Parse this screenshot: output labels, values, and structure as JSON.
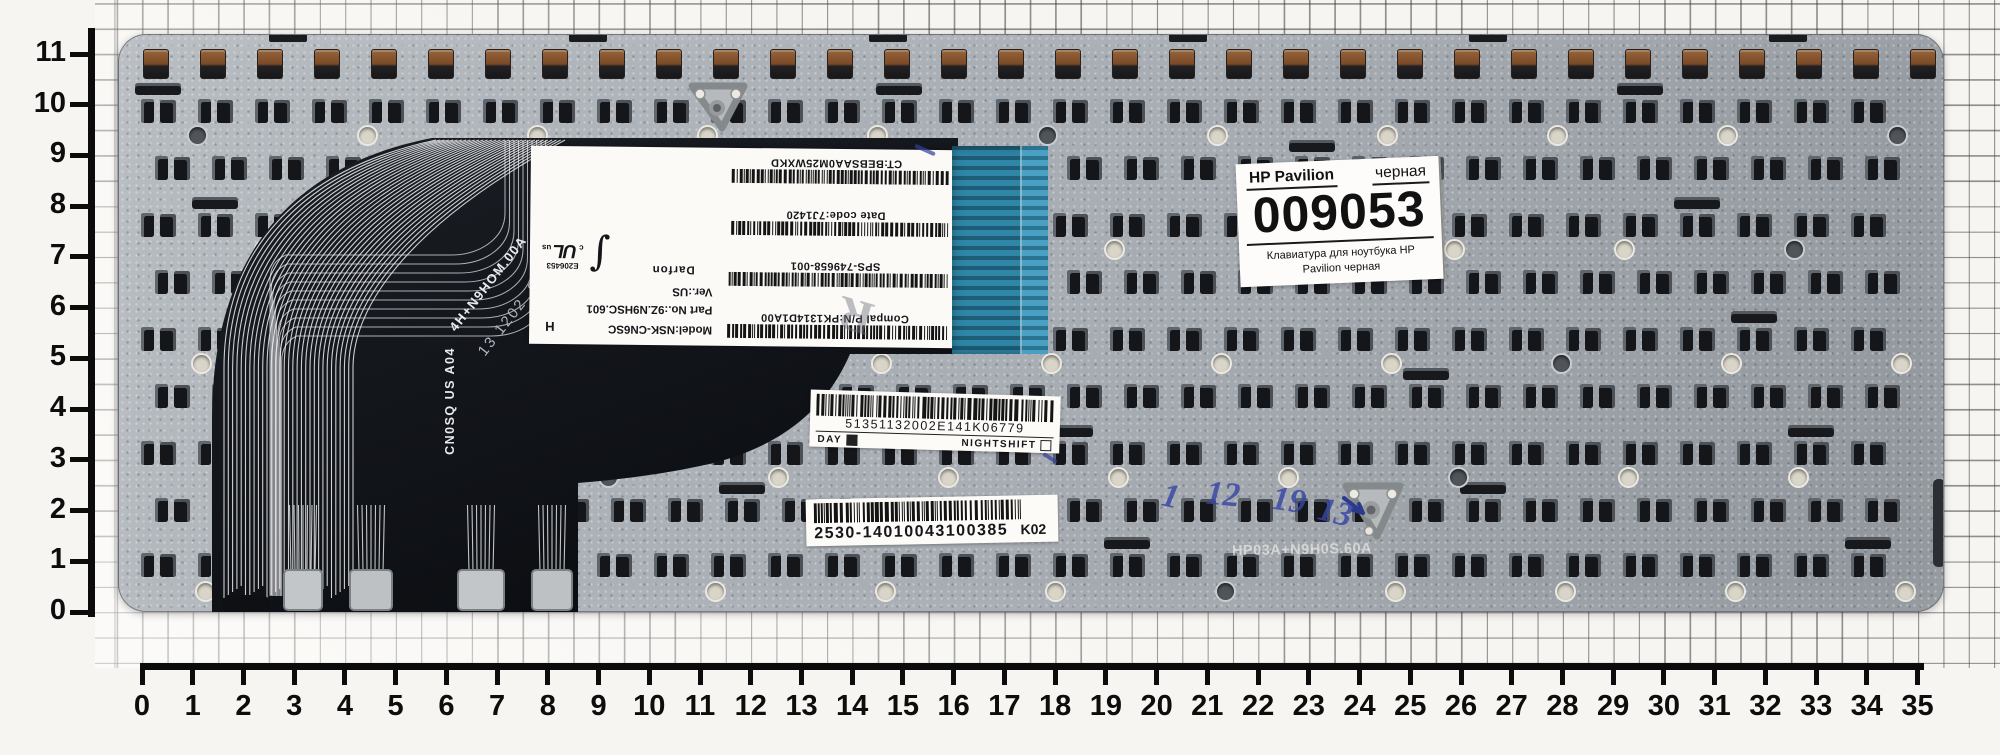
{
  "rulers": {
    "unit": "cm",
    "vertical_labels": [
      "0",
      "1",
      "2",
      "3",
      "4",
      "5",
      "6",
      "7",
      "8",
      "9",
      "10",
      "11"
    ],
    "horizontal_labels": [
      "0",
      "1",
      "2",
      "3",
      "4",
      "5",
      "6",
      "7",
      "8",
      "9",
      "10",
      "11",
      "12",
      "13",
      "14",
      "15",
      "16",
      "17",
      "18",
      "19",
      "20",
      "21",
      "22",
      "23",
      "24",
      "25",
      "26",
      "27",
      "28",
      "29",
      "30",
      "31",
      "32",
      "33",
      "34",
      "35"
    ]
  },
  "shop_label": {
    "brand": "HP Pavilion",
    "variant": "черная",
    "sku": "009053",
    "description": "Клавиатура для ноутбука HP Pavilion черная"
  },
  "factory_label": {
    "barcode_rows": [
      "Compal P/N:PK1314D1A00",
      "SPS-749658-001",
      "Date code:7J1420",
      "CT:BEBSAA0M25WXKD"
    ],
    "model": "Model:NSK-CN6SC",
    "part_no": "Part No.:9Z.N9HSC.601",
    "version": "Ver.:US",
    "manufacturer": "Darfon",
    "ul_number": "E206453",
    "ul_prefix": "c",
    "ul_mark": "UL",
    "ul_suffix": "us",
    "h_mark": "H",
    "r_stamp": "R"
  },
  "cable": {
    "marking_diagonal": "4H+N9HOM.00A",
    "stamp_diagonal": "13 1202",
    "rev": "9B",
    "marking_vertical": "CN0SQ US A04"
  },
  "serial_sticker": {
    "code": "51351132002E141K06779",
    "shift_left": "DAY",
    "shift_right": "NIGHTSHIFT"
  },
  "order_sticker": {
    "code": "2530-14010043100385",
    "suffix": "K02"
  },
  "handwriting": {
    "marks": [
      "1",
      "12",
      "19",
      "13"
    ],
    "color": "#3646a5"
  },
  "faint_stamp": {
    "text": "HP03A+N9H0S.60A"
  },
  "colors": {
    "plate": "#a8aeb4",
    "cable": "#111318",
    "connector_teal": "#2d7a99",
    "hook_brown": "#7a4a28",
    "ruler_black": "#0c0c0c",
    "ink_blue": "#3646a5"
  }
}
